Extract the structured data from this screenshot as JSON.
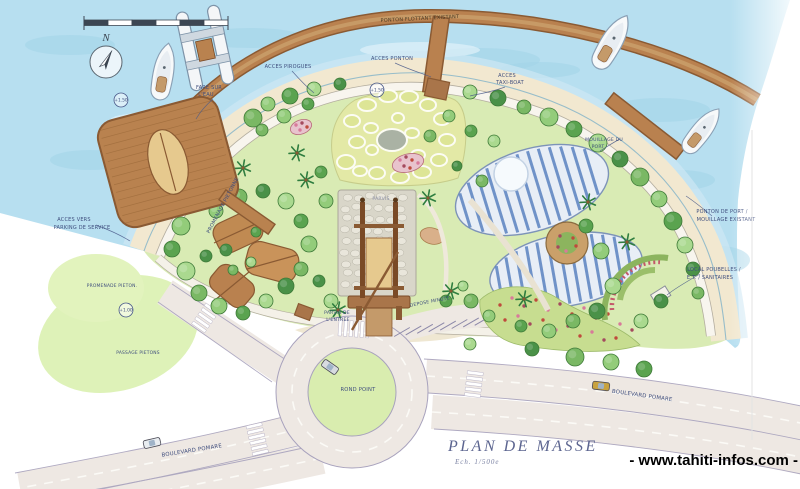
{
  "title": {
    "main": "PLAN DE MASSE",
    "scale_note": "Ech. 1/500e"
  },
  "watermark": "- www.tahiti-infos.com -",
  "compass": {
    "north_label": "N"
  },
  "colors": {
    "ink": "#3f4e7e",
    "water": "#b7dff0",
    "sand": "#f2e8d0",
    "park_green": "#d9ebb4",
    "wood": "#b9814f",
    "road": "#eee8e3",
    "roof_blue": "#5b83c0",
    "title_ink": "#5c6590"
  },
  "annotations": [
    {
      "text": "PONTON FLOTTANT EXISTANT",
      "x": 420,
      "y": 20,
      "size": 5,
      "rotate": -3,
      "color": "#4a3a24"
    },
    {
      "text": "ACCES PIROGUES",
      "x": 288,
      "y": 68,
      "size": 5
    },
    {
      "text": "ACCES PONTON",
      "x": 392,
      "y": 60,
      "size": 5
    },
    {
      "text": "ACCES",
      "x": 507,
      "y": 77,
      "size": 5
    },
    {
      "text": "TAXI-BOAT",
      "x": 510,
      "y": 84,
      "size": 5
    },
    {
      "text": "FARE SUR",
      "x": 209,
      "y": 89,
      "size": 5
    },
    {
      "text": "L'EAU",
      "x": 206,
      "y": 96,
      "size": 5
    },
    {
      "text": "PROMENADE PIETONNE",
      "x": 224,
      "y": 206,
      "size": 5,
      "rotate": -62
    },
    {
      "text": "MOUILLAGE DU",
      "x": 604,
      "y": 141,
      "size": 4.6
    },
    {
      "text": "PORT",
      "x": 598,
      "y": 148,
      "size": 4.6
    },
    {
      "text": "PONTON DE PORT /",
      "x": 722,
      "y": 213,
      "size": 5
    },
    {
      "text": "MOUILLAGE EXISTANT",
      "x": 726,
      "y": 221,
      "size": 5
    },
    {
      "text": "LOCAL POUBELLES /",
      "x": 714,
      "y": 271,
      "size": 5
    },
    {
      "text": "E.T. / SANITAIRES",
      "x": 710,
      "y": 279,
      "size": 5
    },
    {
      "text": "ACCES VERS",
      "x": 74,
      "y": 221,
      "size": 5
    },
    {
      "text": "PARKING DE SERVICE",
      "x": 82,
      "y": 229,
      "size": 5
    },
    {
      "text": "PARVIS",
      "x": 381,
      "y": 200,
      "size": 4.6,
      "color": "#8b8fa8"
    },
    {
      "text": "PARVIS DE",
      "x": 337,
      "y": 314,
      "size": 4.6
    },
    {
      "text": "L'ENTREE",
      "x": 338,
      "y": 321,
      "size": 4.6
    },
    {
      "text": "DEPOSE MINUTE",
      "x": 430,
      "y": 303,
      "size": 4.6,
      "rotate": -11
    },
    {
      "text": "ROND POINT",
      "x": 358,
      "y": 391,
      "size": 5.2
    },
    {
      "text": "BOULEVARD POMARE",
      "x": 192,
      "y": 452,
      "size": 5.4,
      "rotate": -9
    },
    {
      "text": "BOULEVARD POMARE",
      "x": 642,
      "y": 397,
      "size": 5.4,
      "rotate": 8
    },
    {
      "text": "PROMENADE PIETON.",
      "x": 112,
      "y": 287,
      "size": 4.4
    },
    {
      "text": "PASSAGE PIETONS",
      "x": 138,
      "y": 354,
      "size": 4.4
    }
  ],
  "spot_levels": [
    {
      "label": "+1.50",
      "x": 377,
      "y": 90
    },
    {
      "label": "+1.50",
      "x": 121,
      "y": 100
    },
    {
      "label": "+1.00",
      "x": 126,
      "y": 310
    }
  ]
}
